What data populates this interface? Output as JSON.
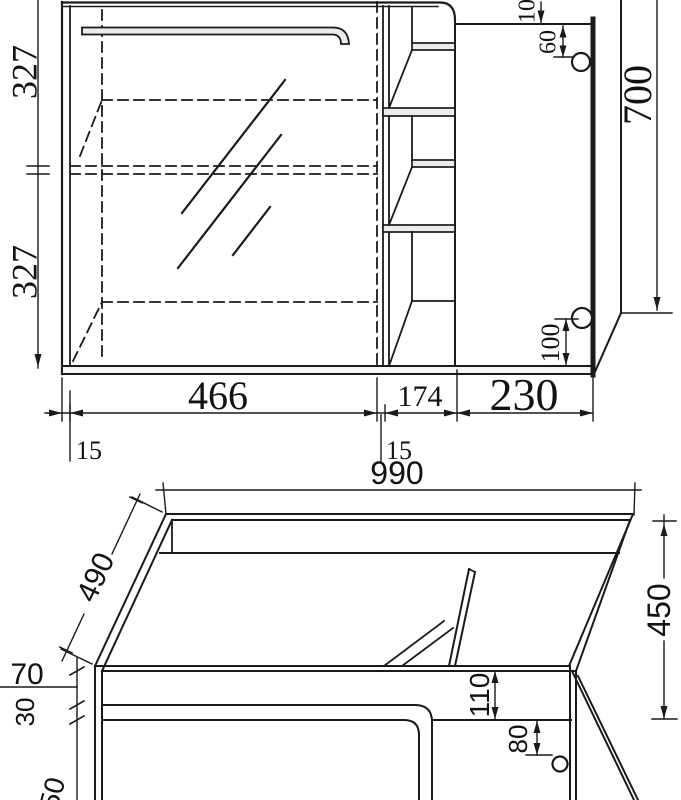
{
  "colors": {
    "line_color": "#1a1a1a",
    "background": "#ffffff",
    "shade": "#ececec"
  },
  "front_view": {
    "dims": {
      "upper_height": "327",
      "lower_height": "327",
      "mirror_width": "466",
      "left_thickness": "15",
      "shelf_width": "174",
      "mid_thickness": "15",
      "door_width": "230",
      "total_height": "700",
      "top_offset": "10",
      "knob_top": "60",
      "knob_bottom": "100"
    }
  },
  "perspective_view": {
    "dims": {
      "width": "990",
      "depth": "490",
      "height": "450",
      "rail_height": "70",
      "lip_height": "30",
      "apron_height": "110",
      "knob_offset": "80",
      "partial_dim": "50"
    }
  }
}
